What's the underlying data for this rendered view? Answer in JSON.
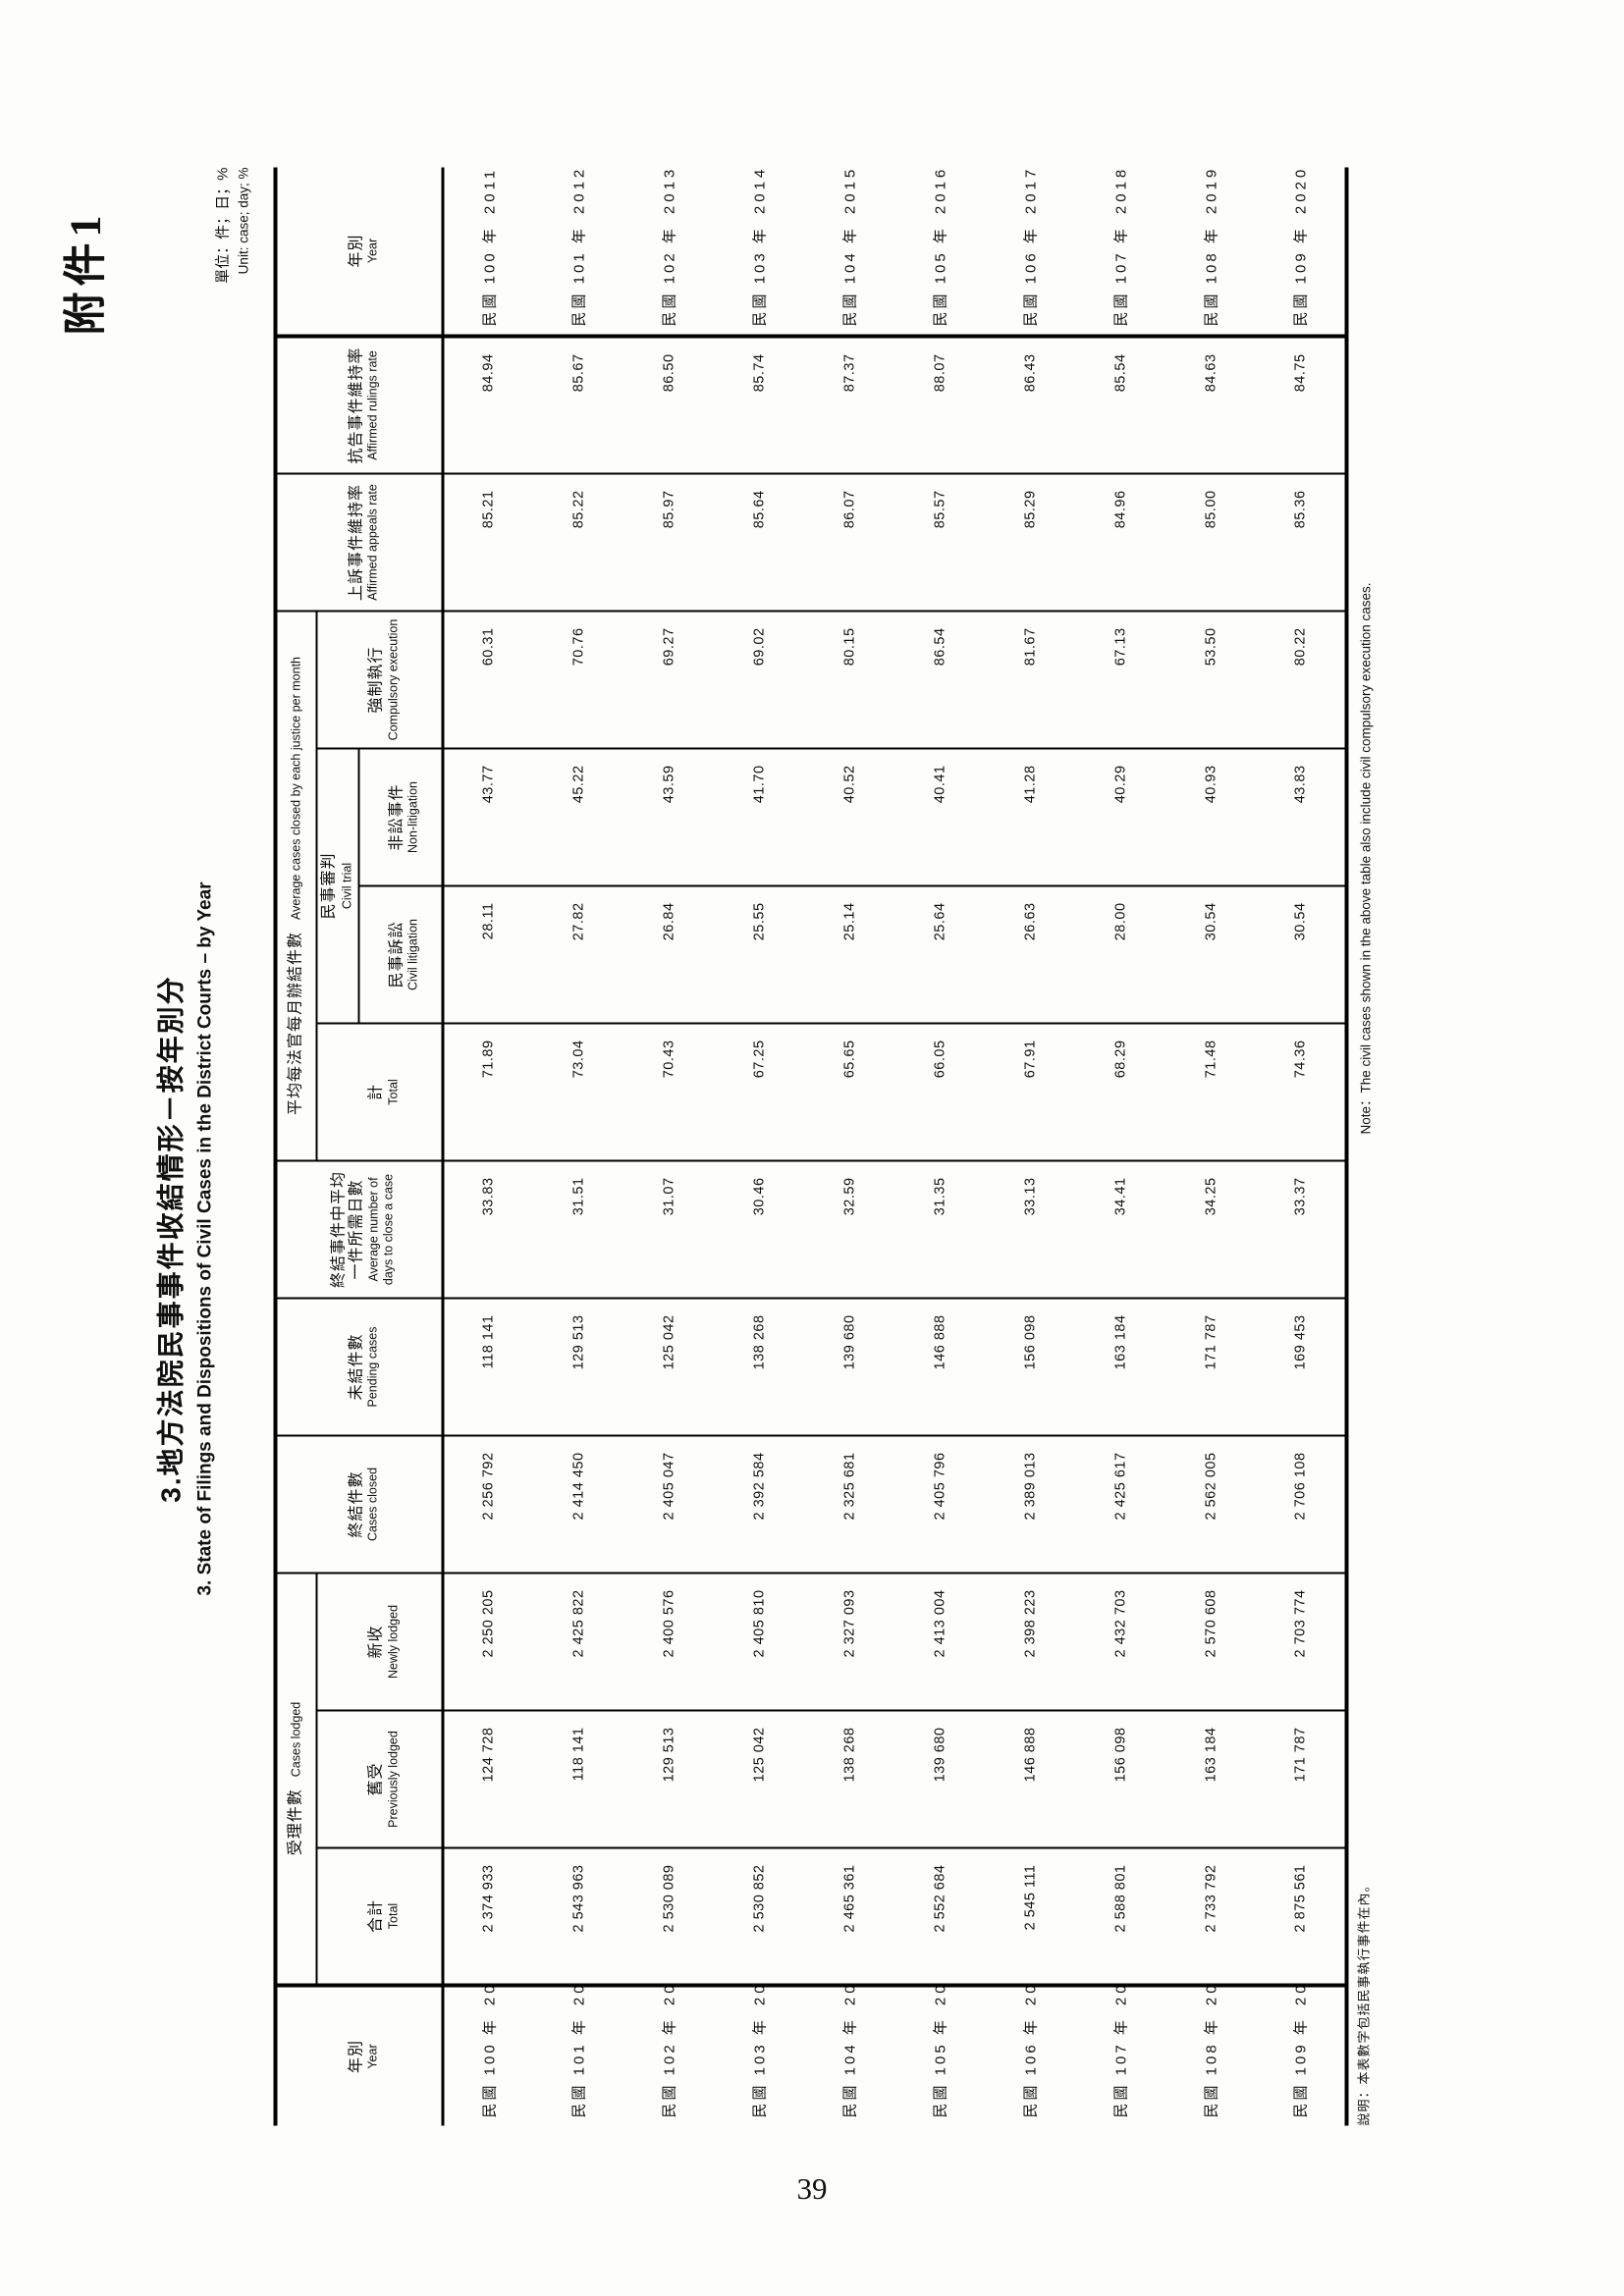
{
  "page": {
    "attachment_label": "附件1",
    "page_number": "39"
  },
  "title": {
    "zh": "3.地方法院民事事件收結情形－按年別分",
    "en": "3. State of Filings and Dispositions of Civil Cases in the District Courts – by Year"
  },
  "unit_note": {
    "zh": "單位：件；日；%",
    "en": "Unit: case; day; %"
  },
  "notes": {
    "zh": "說明：本表數字包括民事執行事件在內。",
    "en": "Note：The civil cases shown in the above table also include civil compulsory execution cases."
  },
  "table": {
    "headers": {
      "year": {
        "zh": "年別",
        "en": "Year"
      },
      "cases_lodged": {
        "zh": "受理件數",
        "en": "Cases lodged"
      },
      "total_lodged": {
        "zh": "合計",
        "en": "Total"
      },
      "previously_lodged": {
        "zh": "舊受",
        "en": "Previously lodged"
      },
      "newly_lodged": {
        "zh": "新收",
        "en": "Newly lodged"
      },
      "cases_closed": {
        "zh": "終結件數",
        "en": "Cases closed"
      },
      "pending_cases": {
        "zh": "未結件數",
        "en": "Pending cases"
      },
      "avg_days": {
        "zh": "終結事件中平均一件所需日數",
        "en": "Average number of days to close a case"
      },
      "avg_monthly": {
        "zh": "平均每法官每月辦結件數",
        "en": "Average cases closed by each justice per month"
      },
      "avg_total": {
        "zh": "計",
        "en": "Total"
      },
      "civil_trial": {
        "zh": "民事審判",
        "en": "Civil trial"
      },
      "civil_litigation": {
        "zh": "民事訴訟",
        "en": "Civil litigation"
      },
      "non_litigation": {
        "zh": "非訟事件",
        "en": "Non-litigation"
      },
      "compulsory_execution": {
        "zh": "強制執行",
        "en": "Compulsory execution"
      },
      "appeals_rate": {
        "zh": "上訴事件維持率",
        "en": "Affirmed appeals rate"
      },
      "rulings_rate": {
        "zh": "抗告事件維持率",
        "en": "Affirmed rulings rate"
      }
    },
    "rows": [
      {
        "year_zh": "民國 100 年",
        "year_ad": "2011",
        "total": "2 374 933",
        "prev": "124 728",
        "new": "2 250 205",
        "closed": "2 256 792",
        "pending": "118 141",
        "avg_days": "33.83",
        "avg_total": "71.89",
        "civil_lit": "28.11",
        "non_lit": "43.77",
        "execution": "60.31",
        "appeals": "85.21",
        "rulings": "84.94"
      },
      {
        "year_zh": "民國 101 年",
        "year_ad": "2012",
        "total": "2 543 963",
        "prev": "118 141",
        "new": "2 425 822",
        "closed": "2 414 450",
        "pending": "129 513",
        "avg_days": "31.51",
        "avg_total": "73.04",
        "civil_lit": "27.82",
        "non_lit": "45.22",
        "execution": "70.76",
        "appeals": "85.22",
        "rulings": "85.67"
      },
      {
        "year_zh": "民國 102 年",
        "year_ad": "2013",
        "total": "2 530 089",
        "prev": "129 513",
        "new": "2 400 576",
        "closed": "2 405 047",
        "pending": "125 042",
        "avg_days": "31.07",
        "avg_total": "70.43",
        "civil_lit": "26.84",
        "non_lit": "43.59",
        "execution": "69.27",
        "appeals": "85.97",
        "rulings": "86.50"
      },
      {
        "year_zh": "民國 103 年",
        "year_ad": "2014",
        "total": "2 530 852",
        "prev": "125 042",
        "new": "2 405 810",
        "closed": "2 392 584",
        "pending": "138 268",
        "avg_days": "30.46",
        "avg_total": "67.25",
        "civil_lit": "25.55",
        "non_lit": "41.70",
        "execution": "69.02",
        "appeals": "85.64",
        "rulings": "85.74"
      },
      {
        "year_zh": "民國 104 年",
        "year_ad": "2015",
        "total": "2 465 361",
        "prev": "138 268",
        "new": "2 327 093",
        "closed": "2 325 681",
        "pending": "139 680",
        "avg_days": "32.59",
        "avg_total": "65.65",
        "civil_lit": "25.14",
        "non_lit": "40.52",
        "execution": "80.15",
        "appeals": "86.07",
        "rulings": "87.37"
      },
      {
        "year_zh": "民國 105 年",
        "year_ad": "2016",
        "total": "2 552 684",
        "prev": "139 680",
        "new": "2 413 004",
        "closed": "2 405 796",
        "pending": "146 888",
        "avg_days": "31.35",
        "avg_total": "66.05",
        "civil_lit": "25.64",
        "non_lit": "40.41",
        "execution": "86.54",
        "appeals": "85.57",
        "rulings": "88.07"
      },
      {
        "year_zh": "民國 106 年",
        "year_ad": "2017",
        "total": "2 545 111",
        "prev": "146 888",
        "new": "2 398 223",
        "closed": "2 389 013",
        "pending": "156 098",
        "avg_days": "33.13",
        "avg_total": "67.91",
        "civil_lit": "26.63",
        "non_lit": "41.28",
        "execution": "81.67",
        "appeals": "85.29",
        "rulings": "86.43"
      },
      {
        "year_zh": "民國 107 年",
        "year_ad": "2018",
        "total": "2 588 801",
        "prev": "156 098",
        "new": "2 432 703",
        "closed": "2 425 617",
        "pending": "163 184",
        "avg_days": "34.41",
        "avg_total": "68.29",
        "civil_lit": "28.00",
        "non_lit": "40.29",
        "execution": "67.13",
        "appeals": "84.96",
        "rulings": "85.54"
      },
      {
        "year_zh": "民國 108 年",
        "year_ad": "2019",
        "total": "2 733 792",
        "prev": "163 184",
        "new": "2 570 608",
        "closed": "2 562 005",
        "pending": "171 787",
        "avg_days": "34.25",
        "avg_total": "71.48",
        "civil_lit": "30.54",
        "non_lit": "40.93",
        "execution": "53.50",
        "appeals": "85.00",
        "rulings": "84.63"
      },
      {
        "year_zh": "民國 109 年",
        "year_ad": "2020",
        "total": "2 875 561",
        "prev": "171 787",
        "new": "2 703 774",
        "closed": "2 706 108",
        "pending": "169 453",
        "avg_days": "33.37",
        "avg_total": "74.36",
        "civil_lit": "30.54",
        "non_lit": "43.83",
        "execution": "80.22",
        "appeals": "85.36",
        "rulings": "84.75"
      }
    ]
  }
}
